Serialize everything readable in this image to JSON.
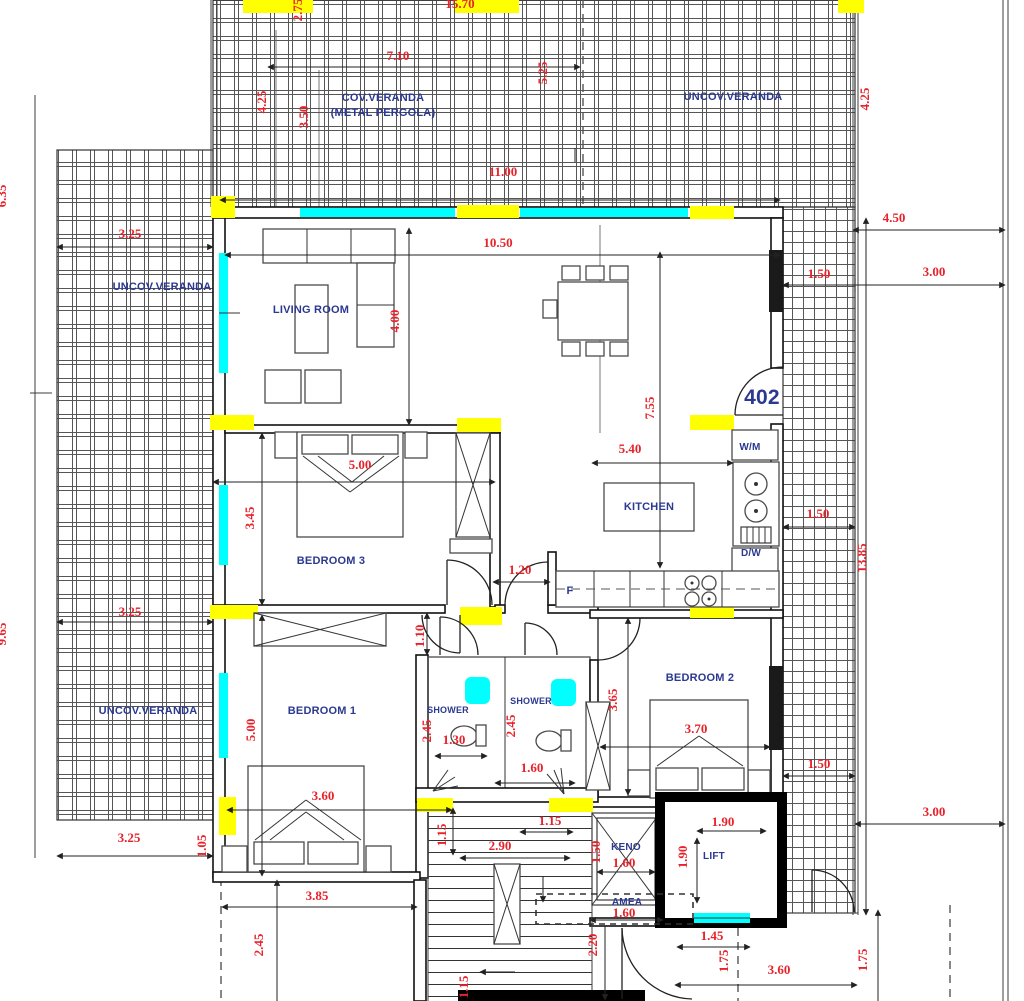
{
  "plan": {
    "unit_label": "402",
    "colors": {
      "dimension_red": "#e8222a",
      "label_blue": "#2b3990",
      "column_yellow": "#ffff00",
      "window_cyan": "#00ffff",
      "wall_black": "#111111",
      "background": "#ffffff"
    },
    "room_labels": [
      {
        "t": "COV.VERANDA",
        "x": 383,
        "y": 101
      },
      {
        "t": "(METAL PERGOLA)",
        "x": 383,
        "y": 116
      },
      {
        "t": "UNCOV.VERANDA",
        "x": 733,
        "y": 100
      },
      {
        "t": "UNCOV.VERANDA",
        "x": 162,
        "y": 290
      },
      {
        "t": "LIVING ROOM",
        "x": 311,
        "y": 313
      },
      {
        "t": "KITCHEN",
        "x": 649,
        "y": 510
      },
      {
        "t": "BEDROOM 3",
        "x": 331,
        "y": 564
      },
      {
        "t": "UNCOV.VERANDA",
        "x": 148,
        "y": 714
      },
      {
        "t": "BEDROOM 1",
        "x": 322,
        "y": 714
      },
      {
        "t": "SHOWER",
        "x": 448,
        "y": 713,
        "s": 9
      },
      {
        "t": "SHOWER",
        "x": 531,
        "y": 704,
        "s": 9
      },
      {
        "t": "BEDROOM 2",
        "x": 700,
        "y": 681
      },
      {
        "t": "W/M",
        "x": 750,
        "y": 450,
        "s": 10
      },
      {
        "t": "D/W",
        "x": 751,
        "y": 556,
        "s": 10
      },
      {
        "t": "F",
        "x": 570,
        "y": 594,
        "s": 11
      },
      {
        "t": "ΚΕΝΟ",
        "x": 626,
        "y": 850,
        "s": 10
      },
      {
        "t": "ΑΜΕΑ",
        "x": 627,
        "y": 905,
        "s": 10
      },
      {
        "t": "LIFT",
        "x": 714,
        "y": 859,
        "s": 10
      },
      {
        "t": "402",
        "x": 762,
        "y": 404,
        "s": 21,
        "c": "#111111"
      }
    ],
    "dimensions": [
      {
        "t": "15.70",
        "x": 460,
        "y": 8
      },
      {
        "t": "2.75",
        "x": 302,
        "y": 10,
        "v": 1
      },
      {
        "t": "7.10",
        "x": 398,
        "y": 60
      },
      {
        "t": "4.25",
        "x": 266,
        "y": 102,
        "v": 1
      },
      {
        "t": "3.50",
        "x": 308,
        "y": 117,
        "v": 1
      },
      {
        "t": "5.25",
        "x": 547,
        "y": 73,
        "v": 1
      },
      {
        "t": "11.00",
        "x": 503,
        "y": 176
      },
      {
        "t": "4.25",
        "x": 869,
        "y": 99,
        "v": 1
      },
      {
        "t": "4.50",
        "x": 894,
        "y": 222
      },
      {
        "t": "3.25",
        "x": 130,
        "y": 238
      },
      {
        "t": "10.50",
        "x": 498,
        "y": 247
      },
      {
        "t": "1.50",
        "x": 819,
        "y": 278
      },
      {
        "t": "3.00",
        "x": 934,
        "y": 276
      },
      {
        "t": "4.00",
        "x": 399,
        "y": 321,
        "v": 1
      },
      {
        "t": "7.55",
        "x": 654,
        "y": 408,
        "v": 1
      },
      {
        "t": "5.00",
        "x": 360,
        "y": 469
      },
      {
        "t": "5.40",
        "x": 630,
        "y": 453
      },
      {
        "t": "3.45",
        "x": 254,
        "y": 518,
        "v": 1
      },
      {
        "t": "1.50",
        "x": 818,
        "y": 518
      },
      {
        "t": "13.85",
        "x": 866,
        "y": 558,
        "v": 1
      },
      {
        "t": "1.20",
        "x": 520,
        "y": 574
      },
      {
        "t": "3.25",
        "x": 130,
        "y": 616
      },
      {
        "t": "1.10",
        "x": 424,
        "y": 636,
        "v": 1
      },
      {
        "t": "2.45",
        "x": 431,
        "y": 731,
        "v": 1
      },
      {
        "t": "1.30",
        "x": 454,
        "y": 744
      },
      {
        "t": "2.45",
        "x": 515,
        "y": 726,
        "v": 1
      },
      {
        "t": "1.60",
        "x": 532,
        "y": 772
      },
      {
        "t": "3.65",
        "x": 617,
        "y": 700,
        "v": 1
      },
      {
        "t": "3.70",
        "x": 696,
        "y": 733
      },
      {
        "t": "5.00",
        "x": 255,
        "y": 730,
        "v": 1
      },
      {
        "t": "3.60",
        "x": 323,
        "y": 800
      },
      {
        "t": "1.50",
        "x": 819,
        "y": 768
      },
      {
        "t": "3.00",
        "x": 934,
        "y": 816
      },
      {
        "t": "3.25",
        "x": 129,
        "y": 842
      },
      {
        "t": "1.05",
        "x": 206,
        "y": 846,
        "v": 1
      },
      {
        "t": "1.15",
        "x": 446,
        "y": 835,
        "v": 1
      },
      {
        "t": "1.15",
        "x": 550,
        "y": 825
      },
      {
        "t": "2.90",
        "x": 500,
        "y": 850
      },
      {
        "t": "1.50",
        "x": 600,
        "y": 852,
        "v": 1
      },
      {
        "t": "1.60",
        "x": 624,
        "y": 867
      },
      {
        "t": "1.90",
        "x": 723,
        "y": 826
      },
      {
        "t": "1.90",
        "x": 687,
        "y": 857,
        "v": 1
      },
      {
        "t": "1.60",
        "x": 624,
        "y": 917
      },
      {
        "t": "2.20",
        "x": 597,
        "y": 945,
        "v": 1
      },
      {
        "t": "1.45",
        "x": 712,
        "y": 940
      },
      {
        "t": "1.75",
        "x": 728,
        "y": 961,
        "v": 1
      },
      {
        "t": "1.75",
        "x": 867,
        "y": 960,
        "v": 1
      },
      {
        "t": "3.60",
        "x": 779,
        "y": 974
      },
      {
        "t": "2.45",
        "x": 263,
        "y": 945,
        "v": 1
      },
      {
        "t": "3.85",
        "x": 317,
        "y": 900
      },
      {
        "t": "1.15",
        "x": 468,
        "y": 987,
        "v": 1
      },
      {
        "t": "6.35",
        "x": 6,
        "y": 196,
        "v": 1
      },
      {
        "t": "9.65",
        "x": 6,
        "y": 634,
        "v": 1
      }
    ]
  }
}
